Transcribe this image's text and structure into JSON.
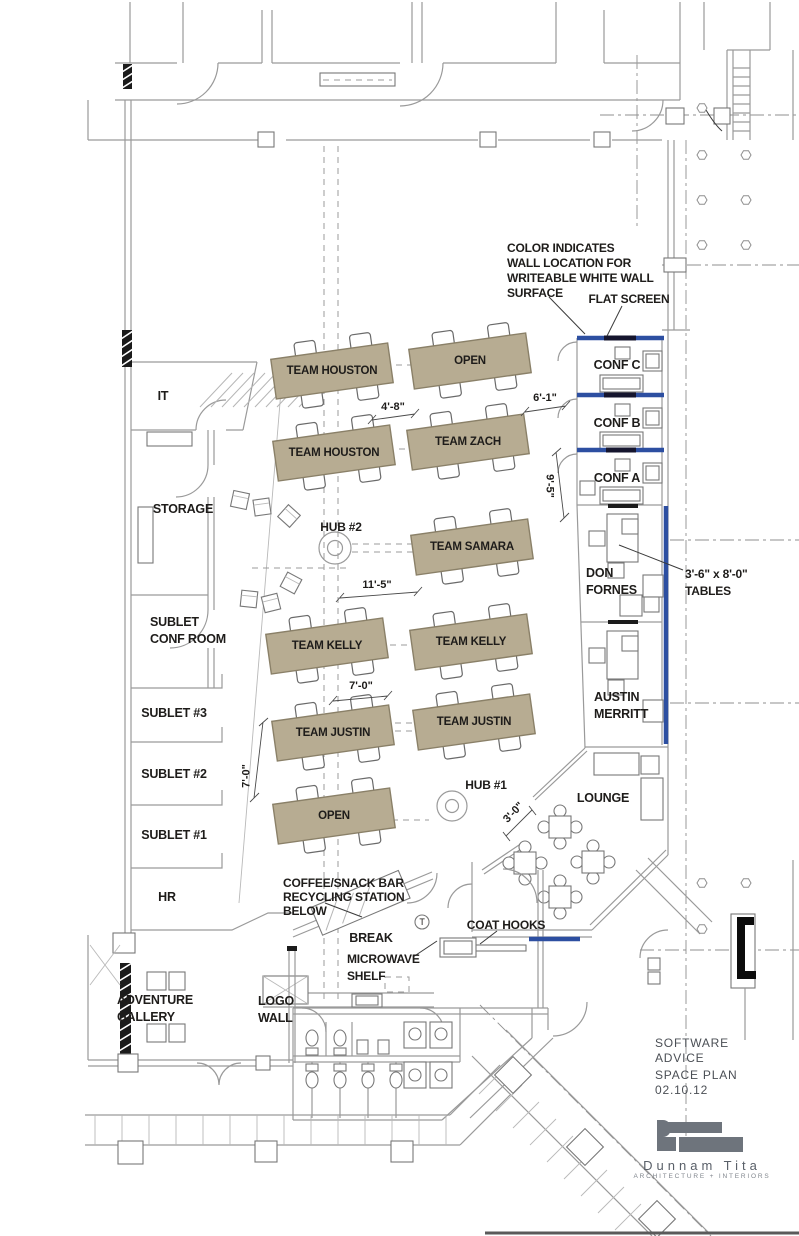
{
  "colors": {
    "desk_fill": "#b7ac92",
    "desk_border": "#8a8068",
    "writeable_wall_blue": "#2d4fa1",
    "flat_screen_dark": "#15152e",
    "wall_gray": "#9a9a9a",
    "wall_dark": "#5a5a5a",
    "text_dark": "#1e1c1a",
    "logo_gray": "#6e747c"
  },
  "rooms": {
    "it": "IT",
    "storage": "STORAGE",
    "sublet_conf": "SUBLET\nCONF ROOM",
    "sublet3": "SUBLET #3",
    "sublet2": "SUBLET #2",
    "sublet1": "SUBLET #1",
    "hr": "HR",
    "adventure_gallery": "ADVENTURE\nGALLERY",
    "logo_wall": "LOGO\nWALL",
    "conf_c": "CONF C",
    "conf_b": "CONF B",
    "conf_a": "CONF A",
    "don_fornes": "DON\nFORNES",
    "austin_merritt": "AUSTIN\nMERRITT",
    "lounge": "LOUNGE",
    "break_room": "BREAK"
  },
  "desks": [
    {
      "label": "TEAM HOUSTON"
    },
    {
      "label": "OPEN"
    },
    {
      "label": "TEAM HOUSTON"
    },
    {
      "label": "TEAM ZACH"
    },
    {
      "label": "TEAM SAMARA"
    },
    {
      "label": "TEAM KELLY"
    },
    {
      "label": "TEAM KELLY"
    },
    {
      "label": "TEAM JUSTIN"
    },
    {
      "label": "TEAM JUSTIN"
    },
    {
      "label": "OPEN"
    }
  ],
  "hubs": {
    "hub1": "HUB #1",
    "hub2": "HUB #2"
  },
  "annotations": {
    "writeable_wall": "COLOR INDICATES\nWALL LOCATION FOR\nWRITEABLE WHITE WALL\nSURFACE",
    "flat_screen": "FLAT SCREEN",
    "tables": "3'-6\" x 8'-0\"\nTABLES",
    "coffee": "COFFEE/SNACK BAR\nRECYCLING STATION\nBELOW",
    "microwave": "MICROWAVE\nSHELF",
    "coat_hooks": "COAT HOOKS",
    "thermostat": "T"
  },
  "dimensions": {
    "d1": "4'-8\"",
    "d2": "6'-1\"",
    "d3": "9'-5\"",
    "d4": "11'-5\"",
    "d5": "7'-0\"",
    "d6": "7'-0\"",
    "d7": "3'-0\""
  },
  "title_block": {
    "client": "SOFTWARE\nADVICE",
    "plan": "SPACE PLAN\n02.10.12",
    "firm_name": "Dunnam Tita",
    "firm_tagline": "ARCHITECTURE  +  INTERIORS"
  }
}
